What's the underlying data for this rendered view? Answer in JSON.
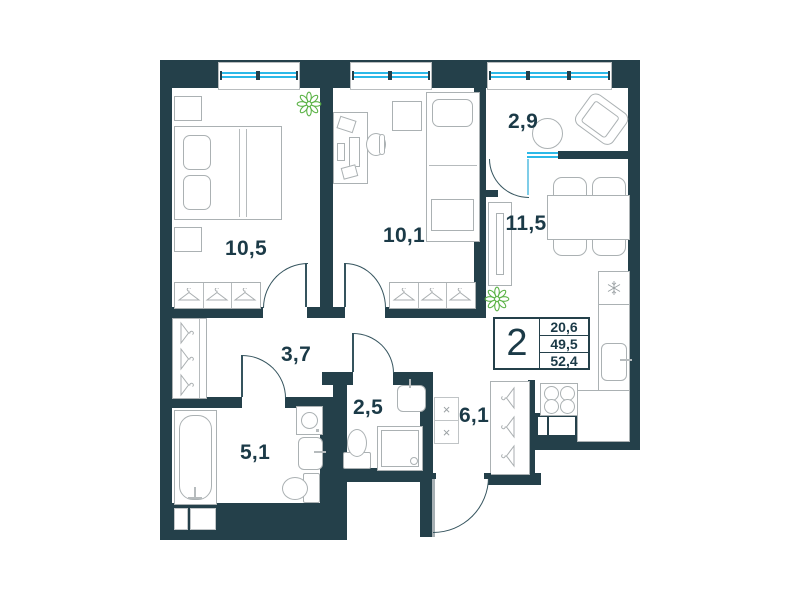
{
  "floor_plan": {
    "unit_label": {
      "rooms_count": "2",
      "areas": [
        "20,6",
        "49,5",
        "52,4"
      ]
    },
    "rooms": [
      {
        "id": "bedroom-1",
        "area_label": "10,5"
      },
      {
        "id": "bedroom-2",
        "area_label": "10,1"
      },
      {
        "id": "balcony",
        "area_label": "2,9"
      },
      {
        "id": "kitchen-living-room",
        "area_label": "11,5"
      },
      {
        "id": "hallway",
        "area_label": "3,7"
      },
      {
        "id": "shower-room",
        "area_label": "2,5"
      },
      {
        "id": "entry-hall",
        "area_label": "6,1"
      },
      {
        "id": "bathroom",
        "area_label": "5,1"
      }
    ],
    "icons": {
      "vent_cross": "×"
    },
    "colors": {
      "wall": "#24404a",
      "glazing": "#2cb9e8",
      "plant": "#5cb347",
      "furniture_line": "#abb1b3",
      "label_text": "#1b3a47"
    }
  }
}
